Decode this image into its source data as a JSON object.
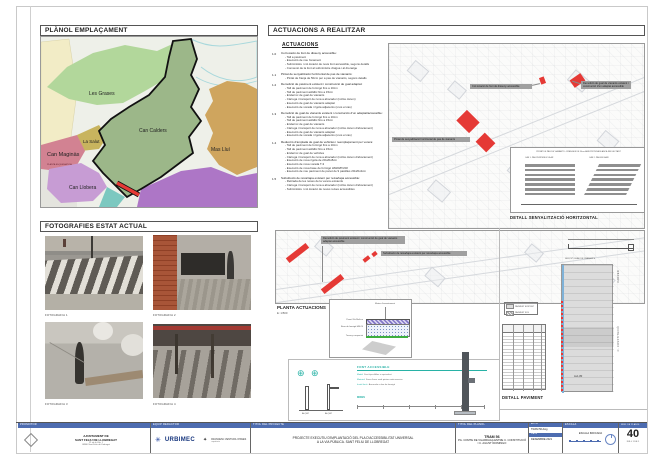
{
  "colors": {
    "accent_red": "#e53935",
    "header_blue": "#4d6cb0",
    "teal": "#28b2a6",
    "zone_les_grases": "#b2d79b",
    "zone_can_calders": "#9cb789",
    "zone_mas_llui": "#cfa55e",
    "zone_la_salut": "#c8b45e",
    "zone_can_maginas": "#d28292",
    "zone_can_llobera": "#c79cd4",
    "zone_teal": "#7cc8c0",
    "zone_purple": "#ad76c6"
  },
  "emplacament": {
    "title": "PLÀNOL EMPLAÇAMENT",
    "zones": [
      "Les Grases",
      "Can Calders",
      "La Salut",
      "Can Maginàs",
      "Can Llobera",
      "Mas Lluí"
    ],
    "map_note": "PLANTA ESQUEMÀTICA"
  },
  "fotografies": {
    "title": "FOTOGRAFIES ESTAT ACTUAL",
    "captions": [
      "FOTOGRAFIA 1",
      "FOTOGRAFIA 2",
      "FOTOGRAFIA 3",
      "FOTOGRAFIA 4"
    ]
  },
  "actuacions": {
    "header": "ACTUACIONS A REALITZAR",
    "list_title": "ACTUACIONS",
    "items": [
      {
        "num": "1.0",
        "title": "Col·locació de font de disseny accessible:",
        "bullets": [
          "- Tall a paviment",
          "- Execució de nou fonament",
          "- Subministre i col·locació de nova font accessible, segons detalls",
          "- Connexió de la font al subministre d'aigua i al drenatge"
        ]
      },
      {
        "num": "1.1",
        "title": "Pintat de senyalització horitzontal de pas de vianants:",
        "bullets": [
          "- Pintat de franja de 50cm per a pas de vianants, segons detalls"
        ]
      },
      {
        "num": "1.2",
        "title": "Demolició de paviment existent i construcció de gual adaptat:",
        "bullets": [
          "- Tall de paviment de formigó fins a 10cm",
          "- Tall de paviment asfàltic fins a 15cm",
          "- Enderroc de gual de vianants",
          "- Càrrega i transport de runa a abocador (inclòs cànon)",
          "- Execució de gual de vianants adaptat",
          "- Execució de vorada i rigola adjacents (si és el cas)"
        ]
      },
      {
        "num": "1.3",
        "title": "Demolició de gual de vianants existent i construcció d'un adaptat/accessible:",
        "bullets": [
          "- Tall de paviment de formigó fins a 10cm",
          "- Tall de paviment asfàltic fins a 15cm",
          "- Enderroc de gual de vianants",
          "- Càrrega i transport de runa a abocador (inclòs cànon d'abocament)",
          "- Execució de gual de vianants adaptat",
          "- Execució de vorada i rigola adjacents (si és el cas)"
        ]
      },
      {
        "num": "1.4",
        "title": "Reducció d'amplada de gual de vehicles i reemplaçament per vorera:",
        "bullets": [
          "- Tall de paviment de formigó fins a 10cm",
          "- Tall de paviment asfàltic fins a 15cm",
          "- Enderroc de gual de vehicles",
          "- Càrrega i transport de runa a abocador (inclòs cànon d'abocament)",
          "- Execució de nova rigola de 20x20x8cm",
          "- Execució de nova vorada T-3",
          "- Execució de nova base de formigó HM20/P/20/I",
          "- Execució de nou paviment de panot de 9 pastilles 20x20x4cm"
        ]
      },
      {
        "num": "1.5",
        "title": "Substitució de reixa/tapa existent per reixa/tapa accessible:",
        "bullets": [
          "- Retirada de les reixes de la vorera existents",
          "- Càrrega i transport de runa a abocador (inclòs cànon d'abocament)",
          "- Subministre i col·locació de noves reixes accessibles"
        ]
      }
    ]
  },
  "plan": {
    "callouts": [
      "Col·locació de font de disseny accessible",
      "Demolició de gual de vianants existent i construcció d'un adaptat accessible",
      "Pintat de senyalització horitzontal de pas de vianants",
      "Demolició de paviment existent i construcció de gual de vianants adaptat accessible",
      "Substitució de reixa/tapa existent per reixa/tapa accessible"
    ]
  },
  "details": {
    "senyalitzacio": {
      "note_top": "PINTAT DE PAS DE VIANANTS - FRANGES DE 50cm AMB PINTURA BLANCA REFLECTANT",
      "case_left": "CAS 1: PAS PERPENDICULAR",
      "case_right": "CAS 2: PAS EN BIAIX",
      "label": "DETALL SENYALITZACIÓ HORITZONTAL"
    },
    "planta": {
      "label": "PLANTA ACTUACIONS",
      "scale": "E: 1/500"
    },
    "paviment_seccio": {
      "ann_top": "Morter d'assentament",
      "ann_left": [
        "Panot 20x20x4cm",
        "Base de formigó HM-20",
        "Terreny compactat"
      ]
    },
    "font_panel": {
      "title": "FONT ACCESSIBLE",
      "specs": [
        {
          "k": "Model",
          "v": "Font tipus Atlas o equivalent"
        },
        {
          "k": "Material",
          "v": "Fosa d'acer amb pintura anticorrosiva"
        },
        {
          "k": "Instal·lació",
          "v": "Ancorada a dau de formigó"
        }
      ],
      "mides_title": "MIDES",
      "alçat_left": "ALÇAT",
      "alçat_right": "ALÇAT"
    },
    "detall_paviment": {
      "label": "DETALL PAVIMENT",
      "seccio_caption": "SECCIÓ GUAL DE VIANANTS",
      "street_label_top": "CARRER",
      "street_label_bottom": "C. CONSTITUCIÓ",
      "dim_label": "A≥1,80",
      "legend": [
        "PAVIMENT EXISTENT",
        "PAVIMENT NOU"
      ]
    }
  },
  "titleblock": {
    "promotor_header": "PROMOTOR",
    "promotor_line1": "AJUNTAMENT DE",
    "promotor_line2": "SANT FELIU DE LLOBREGAT",
    "promotor_addr1": "Pl. de la Vila, 1",
    "promotor_addr2": "08980 Sant Feliu de Llobregat",
    "equip_header": "EQUIP REDACTOR",
    "equip_logo1": "URBIMEC",
    "equip_logo2a": "FRANCESC VENTURA I PANES",
    "equip_logo2b": "arquitecte",
    "projecte_header": "TÍTOL DEL PROJECTE",
    "projecte_line1": "PROJECTE EXECUTIU D'IMPLANTACIÓ DEL PLA D'ACCESSIBILITAT UNIVERSAL",
    "projecte_line2": "A LA VIA PÚBLICA. SANT FELIU DE LLOBREGAT",
    "planol_header": "TÍTOL DEL PLÀNOL",
    "planol_line1": "TRAM 56",
    "planol_line2": "PG. COMTE DE VILARDAGA ENTRE C. CONSTITUCIÓ",
    "planol_line3": "I C. AGUSTÍ DOMINGO",
    "arxiu_header": "ARXIU",
    "arxiu_value": "TRAM 56.dwg",
    "data_header": "DATA",
    "data_value": "DESEMBRE 2021",
    "escala_header": "ESCALA",
    "escala_value": "ESCALA INDICADA",
    "num_header": "NÚM. DE PLÀNOL",
    "num_value": "40",
    "full_value": "FULL 1 DE 1"
  }
}
